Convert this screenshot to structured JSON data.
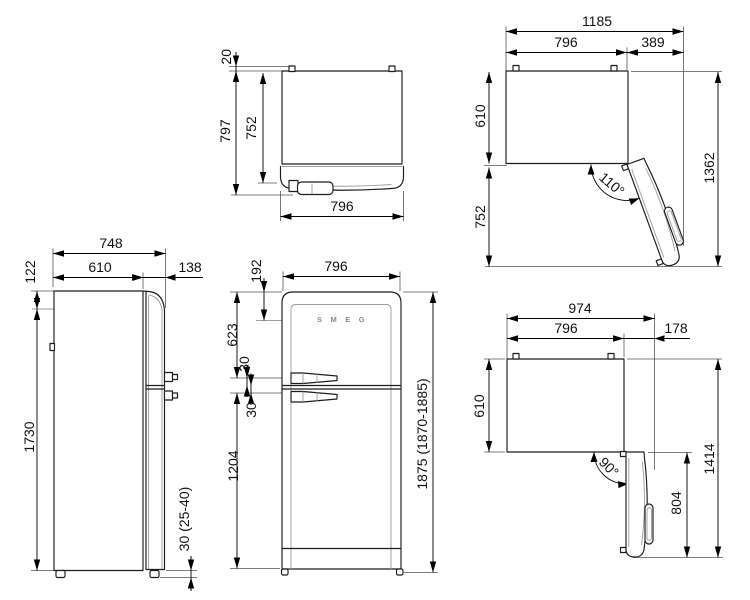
{
  "drawing": {
    "product": "refrigerator-dimension-drawing",
    "brand_color": "#1c1c1c",
    "views": {
      "top_closed": {
        "clearance": "20",
        "depth_overall": "797",
        "depth_case": "752",
        "width": "796"
      },
      "open_110": {
        "width_overall": "1185",
        "width_case": "796",
        "door_projection": "389",
        "depth_case": "610",
        "door_swing": "752",
        "depth_overall": "1362",
        "angle": "110°"
      },
      "side": {
        "depth_overall": "748",
        "depth_case": "610",
        "door_depth": "138",
        "top_section": "122",
        "height_case": "1730",
        "feet": "30 (25-40)"
      },
      "front": {
        "logo_offset": "192",
        "width": "796",
        "upper_door": "623",
        "gap_upper": "30",
        "gap_lower": "30",
        "lower_door": "1204",
        "height_overall": "1875 (1870-1885)",
        "brand": "SMEG"
      },
      "open_90": {
        "width_overall": "974",
        "width_case": "796",
        "door_projection": "178",
        "depth_case": "610",
        "depth_overall": "1414",
        "door_length": "804",
        "angle": "90°"
      }
    }
  }
}
